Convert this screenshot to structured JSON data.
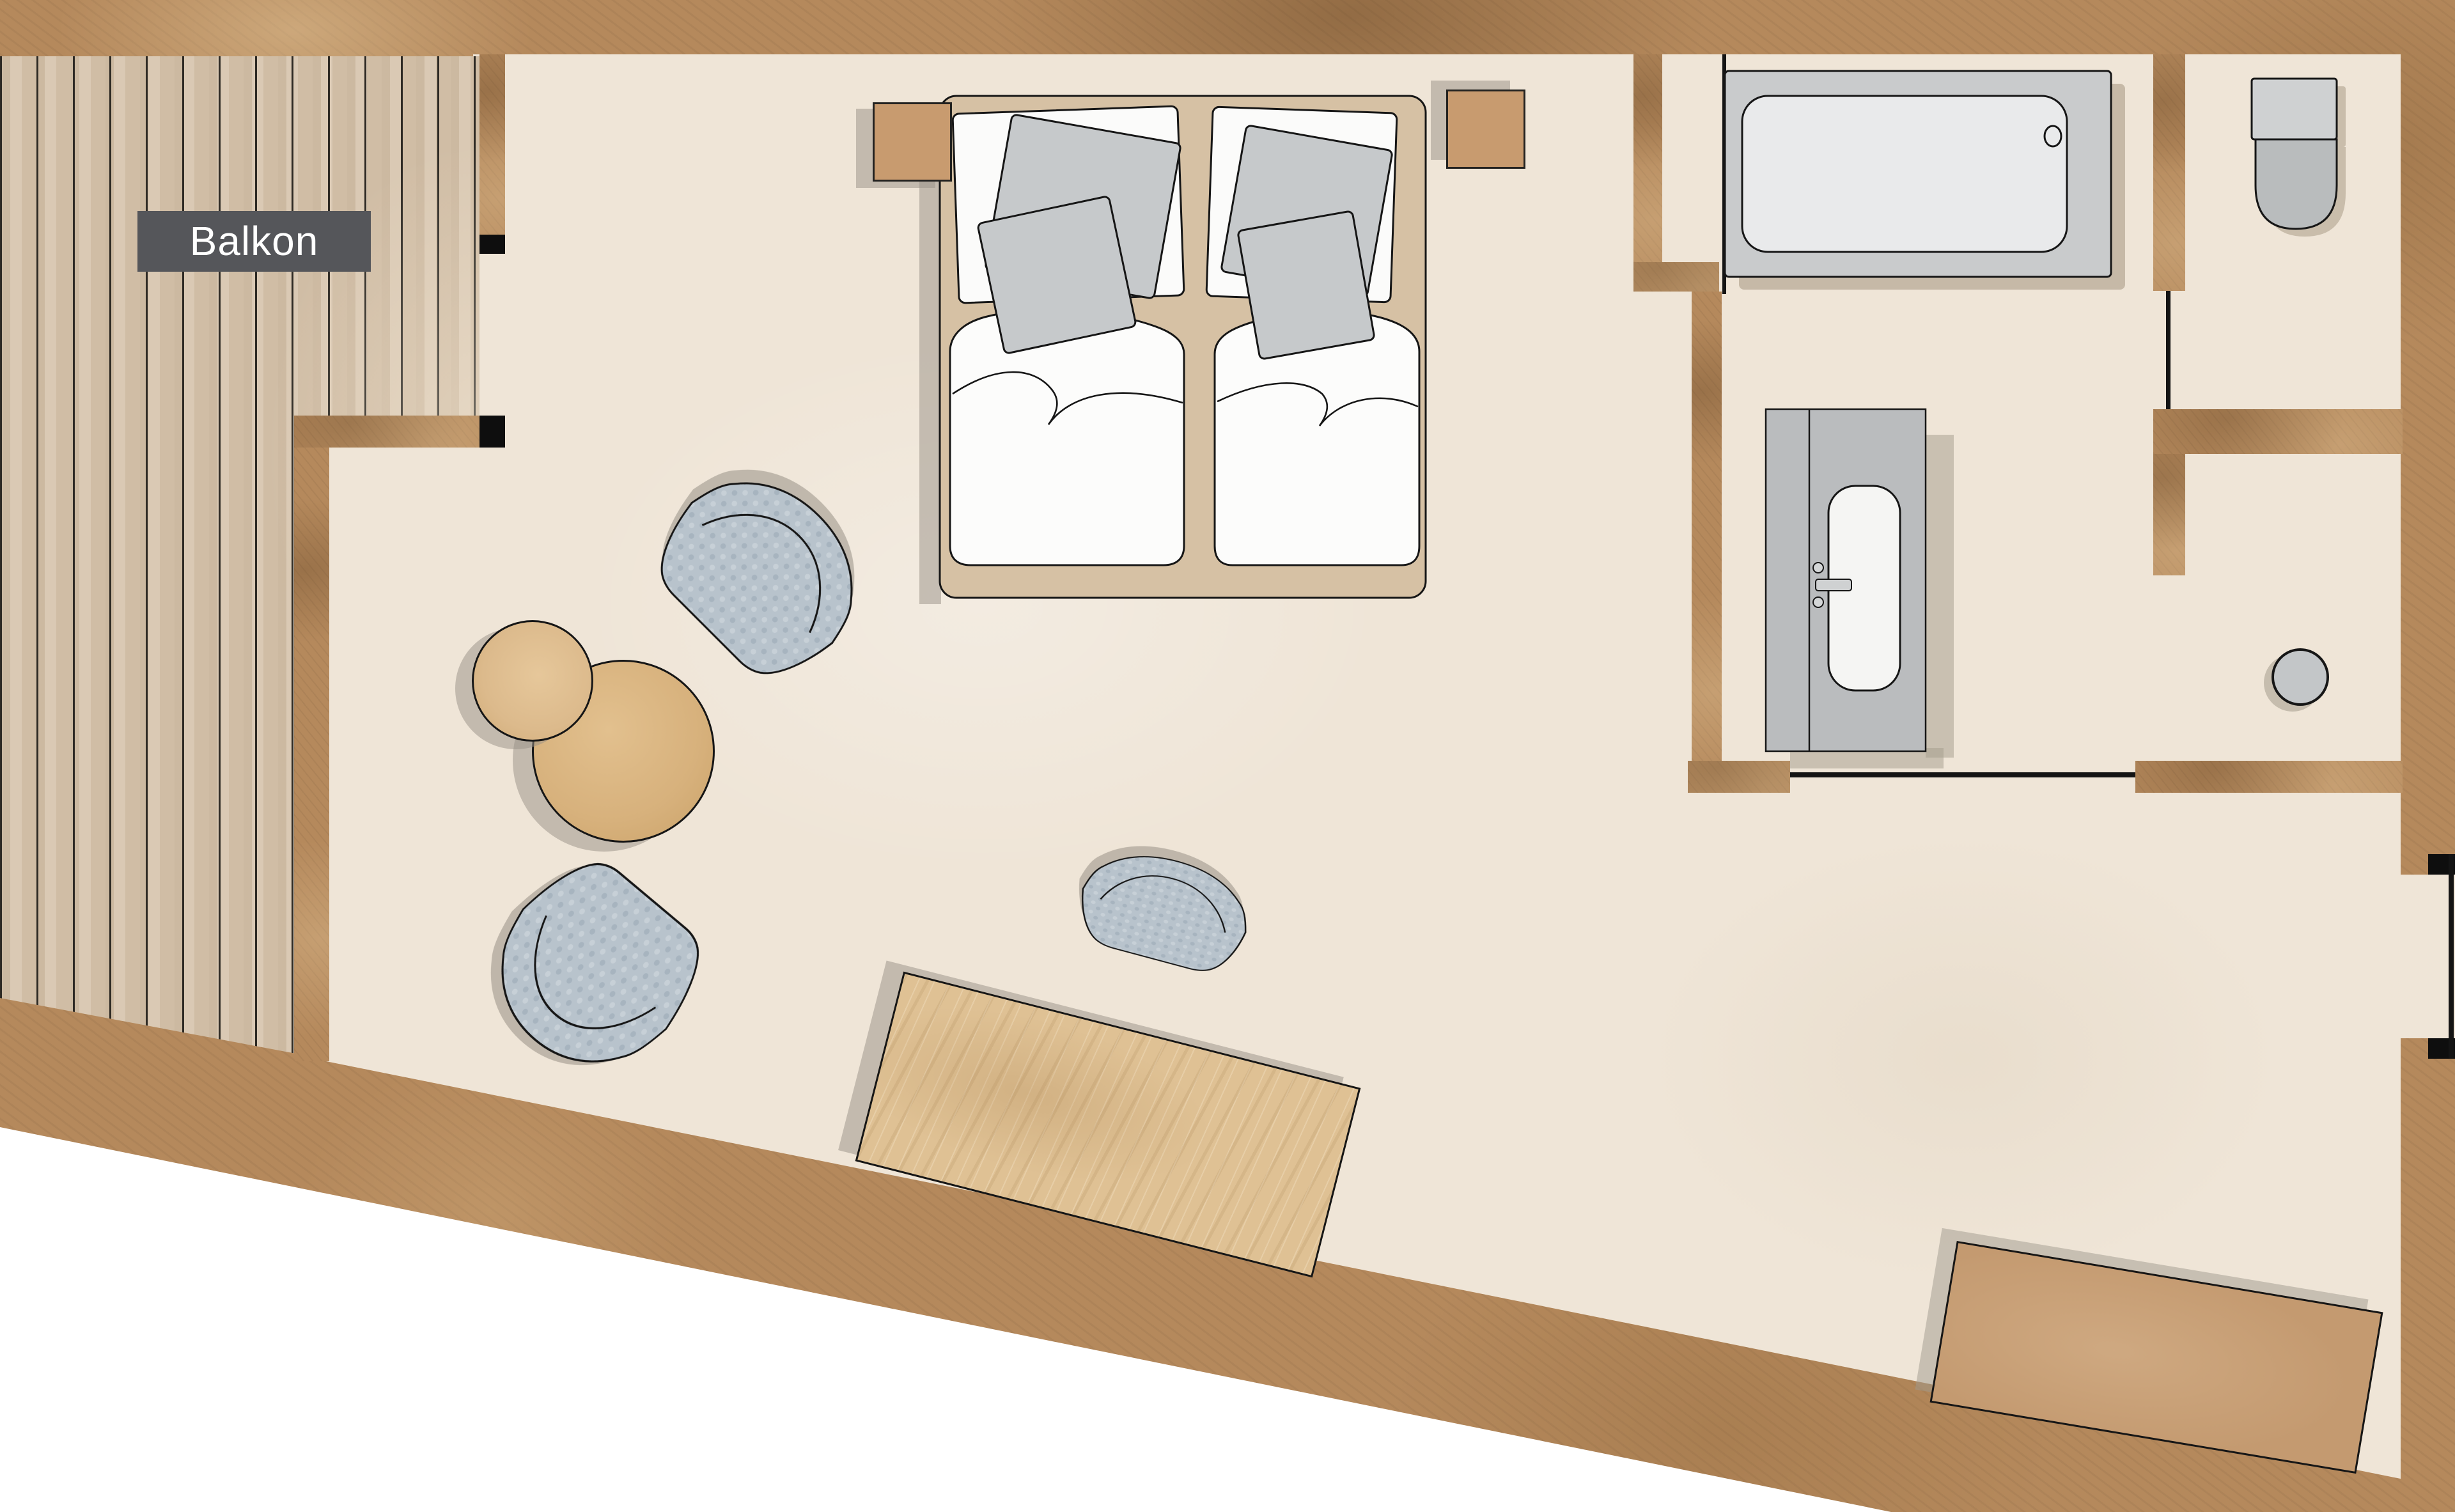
{
  "page": {
    "type": "architectural-floor-plan",
    "style": "top-down hotel suite plan"
  },
  "balcony": {
    "label": "Balkon"
  },
  "rooms": [
    "balcony",
    "bedroom-living-area",
    "bathroom",
    "toilet-room",
    "closet-nook"
  ],
  "furniture_icons": [
    "double-bed-icon",
    "nightstand-icon",
    "pillow-icon",
    "cushion-icon",
    "duvet-icon",
    "armchair-icon",
    "coffee-table-icon",
    "desk-icon",
    "desk-chair-icon",
    "sideboard-bench-icon",
    "bathtub-icon",
    "drain-icon",
    "vanity-sink-icon",
    "faucet-icon",
    "toilet-icon",
    "stool-icon",
    "window-icon",
    "door-opening-icon"
  ],
  "colors": {
    "wall": "#b5895c",
    "floor": "#efe5d7",
    "deck_wood": "#d6c3ab",
    "outside": "#ffffff",
    "label_bg": "#55565a",
    "label_text": "#ffffff",
    "outline": "#161616",
    "bed_frame": "#d6c1a4",
    "linen_white": "#fcfcfb",
    "cushion_gray": "#c6c9cb",
    "fabric_weave": "#b8c3cc",
    "fixture_gray": "#c9cbcc",
    "fixture_light": "#e9eaeb",
    "vanity_gray": "#babcbe",
    "oak_table": "#d7b17c",
    "desk_wood": "#dfc194",
    "tan_furniture": "#c89b6f",
    "bench_tan": "#c49a70",
    "shadow": "rgba(151,144,133,0.55)"
  }
}
